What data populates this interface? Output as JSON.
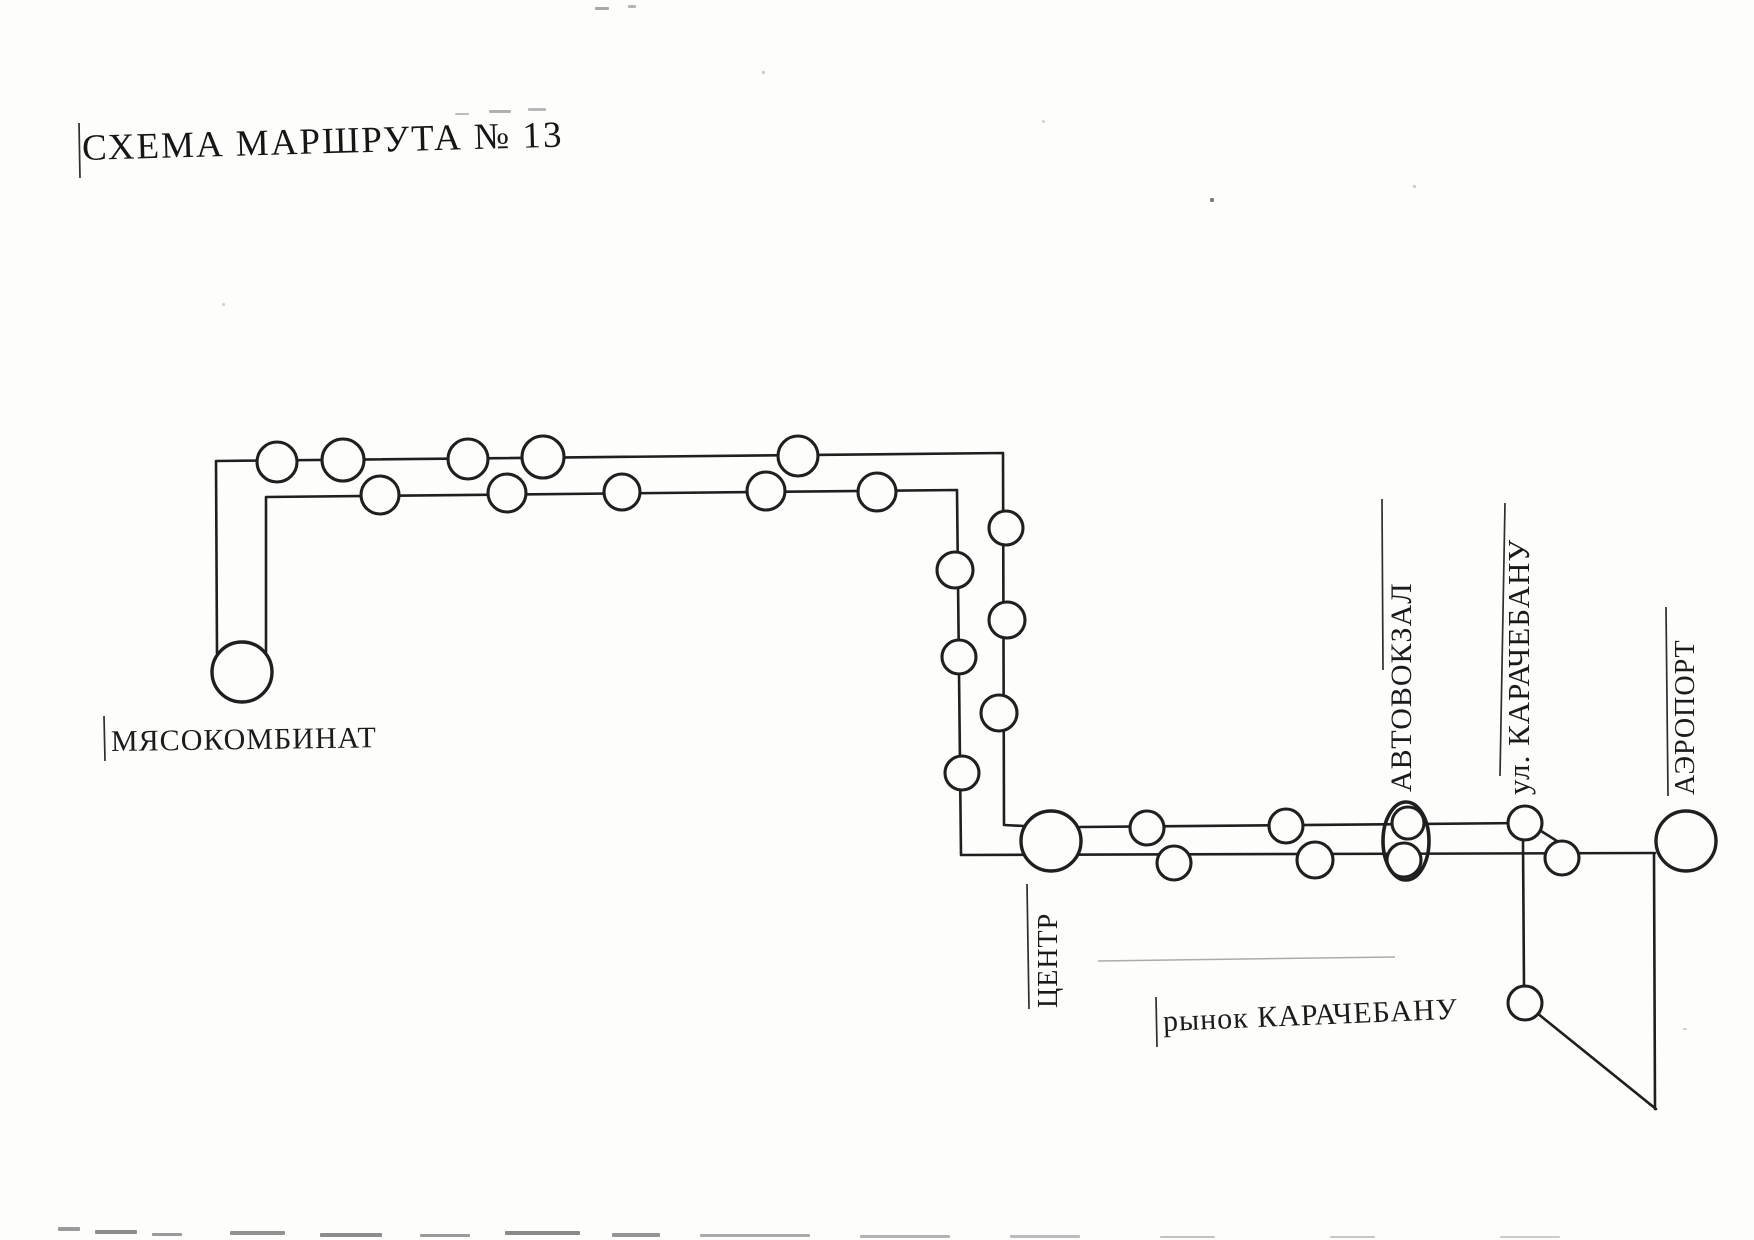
{
  "labels": {
    "title": "СХЕМА МАРШРУТА № 13",
    "myasokombinat": "МЯСОКОМБИНАТ",
    "centr": "ЦЕНТР",
    "avtovokzal": "АВТОВОКЗАЛ",
    "ul_karachebanu": "ул. КАРАЧЕБАНУ",
    "aeroport": "АЭРОПОРТ",
    "rynok_karachebanu": "рынок КАРАЧЕБАНУ"
  },
  "diagram": {
    "ink": "#1f1f1f",
    "paper": "#fdfdfc",
    "route_number": "13",
    "route_lines": [
      {
        "name": "outbound-line",
        "points": [
          [
            217,
            653
          ],
          [
            216,
            461
          ],
          [
            1003,
            453
          ],
          [
            1004,
            825
          ],
          [
            1024,
            826
          ]
        ]
      },
      {
        "name": "center-upper-line",
        "points": [
          [
            1080,
            827
          ],
          [
            1525,
            823
          ]
        ]
      },
      {
        "name": "return-line",
        "points": [
          [
            266,
            652
          ],
          [
            266,
            497
          ],
          [
            957,
            490
          ],
          [
            961,
            855
          ],
          [
            1655,
            853
          ]
        ]
      },
      {
        "name": "market-branch-line",
        "points": [
          [
            1523,
            841
          ],
          [
            1524,
            986
          ]
        ]
      },
      {
        "name": "market-diagonal-line",
        "points": [
          [
            1537,
            1013
          ],
          [
            1656,
            1109
          ]
        ]
      },
      {
        "name": "airport-branch-line",
        "points": [
          [
            1654,
            854
          ],
          [
            1655,
            1109
          ]
        ]
      },
      {
        "name": "merge-connector-line",
        "points": [
          [
            1541,
            831
          ],
          [
            1573,
            851
          ]
        ]
      }
    ],
    "faint_lines": [
      {
        "name": "faint-artifact-line",
        "color": "#ababab",
        "points": [
          [
            1098,
            961
          ],
          [
            1395,
            957
          ]
        ]
      }
    ],
    "stops": [
      {
        "x": 242,
        "y": 672,
        "r": 30,
        "label": "МЯСОКОМБИНАТ",
        "terminal": true
      },
      {
        "x": 1051,
        "y": 841,
        "r": 30,
        "label": "ЦЕНТР",
        "terminal": true
      },
      {
        "x": 1686,
        "y": 841,
        "r": 30,
        "label": "АЭРОПОРТ",
        "terminal": true
      },
      {
        "x": 277,
        "y": 462,
        "r": 20,
        "label": "",
        "terminal": false
      },
      {
        "x": 343,
        "y": 460,
        "r": 21,
        "label": "",
        "terminal": false
      },
      {
        "x": 468,
        "y": 459,
        "r": 20,
        "label": "",
        "terminal": false
      },
      {
        "x": 543,
        "y": 457,
        "r": 21,
        "label": "",
        "terminal": false
      },
      {
        "x": 798,
        "y": 456,
        "r": 20,
        "label": "",
        "terminal": false
      },
      {
        "x": 380,
        "y": 495,
        "r": 19,
        "label": "",
        "terminal": false
      },
      {
        "x": 507,
        "y": 493,
        "r": 19,
        "label": "",
        "terminal": false
      },
      {
        "x": 622,
        "y": 492,
        "r": 18,
        "label": "",
        "terminal": false
      },
      {
        "x": 766,
        "y": 491,
        "r": 19,
        "label": "",
        "terminal": false
      },
      {
        "x": 877,
        "y": 492,
        "r": 19,
        "label": "",
        "terminal": false
      },
      {
        "x": 1006,
        "y": 528,
        "r": 17,
        "label": "",
        "terminal": false
      },
      {
        "x": 1007,
        "y": 620,
        "r": 18,
        "label": "",
        "terminal": false
      },
      {
        "x": 999,
        "y": 713,
        "r": 18,
        "label": "",
        "terminal": false
      },
      {
        "x": 955,
        "y": 570,
        "r": 18,
        "label": "",
        "terminal": false
      },
      {
        "x": 959,
        "y": 657,
        "r": 17,
        "label": "",
        "terminal": false
      },
      {
        "x": 962,
        "y": 773,
        "r": 17,
        "label": "",
        "terminal": false
      },
      {
        "x": 1147,
        "y": 828,
        "r": 17,
        "label": "",
        "terminal": false
      },
      {
        "x": 1286,
        "y": 826,
        "r": 17,
        "label": "",
        "terminal": false
      },
      {
        "x": 1408,
        "y": 823,
        "r": 16,
        "label": "АВТОВОКЗАЛ",
        "terminal": false
      },
      {
        "x": 1525,
        "y": 823,
        "r": 17,
        "label": "ул. КАРАЧЕБАНУ",
        "terminal": false
      },
      {
        "x": 1174,
        "y": 863,
        "r": 17,
        "label": "",
        "terminal": false
      },
      {
        "x": 1315,
        "y": 860,
        "r": 18,
        "label": "",
        "terminal": false
      },
      {
        "x": 1404,
        "y": 860,
        "r": 17,
        "label": "АВТОВОКЗАЛ",
        "terminal": false
      },
      {
        "x": 1562,
        "y": 858,
        "r": 17,
        "label": "",
        "terminal": false
      },
      {
        "x": 1525,
        "y": 1003,
        "r": 17,
        "label": "рынок КАРАЧЕБАНУ",
        "terminal": false
      }
    ],
    "hub_oval": {
      "cx": 1406,
      "cy": 841,
      "rx": 23,
      "ry": 39,
      "label": "АВТОВОКЗАЛ"
    },
    "label_lines": [
      {
        "name": "title-tick",
        "x1": 79,
        "y1": 123,
        "x2": 80,
        "y2": 178
      },
      {
        "name": "myasokombinat-tick",
        "x1": 104,
        "y1": 716,
        "x2": 105,
        "y2": 761
      },
      {
        "name": "centr-label-line",
        "x1": 1027,
        "y1": 884,
        "x2": 1029,
        "y2": 1009
      },
      {
        "name": "avtovokzal-label-line",
        "x1": 1382,
        "y1": 499,
        "x2": 1383,
        "y2": 670
      },
      {
        "name": "karachebanu-label-line",
        "x1": 1505,
        "y1": 503,
        "x2": 1500,
        "y2": 776
      },
      {
        "name": "aeroport-label-line",
        "x1": 1666,
        "y1": 607,
        "x2": 1668,
        "y2": 796
      },
      {
        "name": "rynok-tick",
        "x1": 1156,
        "y1": 997,
        "x2": 1157,
        "y2": 1047
      }
    ],
    "artifacts": [
      {
        "x": 595,
        "y": 7,
        "w": 14,
        "h": 3,
        "c": "#a8a8a8"
      },
      {
        "x": 628,
        "y": 5,
        "w": 8,
        "h": 3,
        "c": "#b5b5b5"
      },
      {
        "x": 455,
        "y": 113,
        "w": 14,
        "h": 2,
        "c": "#bdbdbd"
      },
      {
        "x": 489,
        "y": 110,
        "w": 22,
        "h": 3,
        "c": "#b0b0b0"
      },
      {
        "x": 528,
        "y": 108,
        "w": 18,
        "h": 3,
        "c": "#b8b8b8"
      },
      {
        "x": 1210,
        "y": 198,
        "w": 4,
        "h": 4,
        "c": "#7d7d7d"
      },
      {
        "x": 762,
        "y": 71,
        "w": 3,
        "h": 3,
        "c": "#c9c9c9"
      },
      {
        "x": 1413,
        "y": 185,
        "w": 3,
        "h": 3,
        "c": "#cccccc"
      },
      {
        "x": 222,
        "y": 303,
        "w": 3,
        "h": 3,
        "c": "#d2d2d2"
      },
      {
        "x": 1042,
        "y": 120,
        "w": 3,
        "h": 3,
        "c": "#d5d5d5"
      },
      {
        "x": 1683,
        "y": 1028,
        "w": 4,
        "h": 2,
        "c": "#cfcfcf"
      },
      {
        "x": 58,
        "y": 1227,
        "w": 22,
        "h": 4,
        "c": "#9a9a9a"
      },
      {
        "x": 95,
        "y": 1230,
        "w": 42,
        "h": 4,
        "c": "#8e8e8e"
      },
      {
        "x": 152,
        "y": 1233,
        "w": 30,
        "h": 3,
        "c": "#999999"
      },
      {
        "x": 230,
        "y": 1231,
        "w": 55,
        "h": 4,
        "c": "#929292"
      },
      {
        "x": 320,
        "y": 1233,
        "w": 62,
        "h": 4,
        "c": "#8c8c8c"
      },
      {
        "x": 420,
        "y": 1234,
        "w": 50,
        "h": 3,
        "c": "#9a9a9a"
      },
      {
        "x": 505,
        "y": 1231,
        "w": 75,
        "h": 4,
        "c": "#8a8a8a"
      },
      {
        "x": 612,
        "y": 1233,
        "w": 48,
        "h": 4,
        "c": "#949494"
      },
      {
        "x": 700,
        "y": 1234,
        "w": 110,
        "h": 3,
        "c": "#ababab"
      },
      {
        "x": 860,
        "y": 1235,
        "w": 90,
        "h": 3,
        "c": "#b3b3b3"
      },
      {
        "x": 1010,
        "y": 1235,
        "w": 70,
        "h": 3,
        "c": "#bcbcbc"
      },
      {
        "x": 1160,
        "y": 1236,
        "w": 55,
        "h": 2,
        "c": "#c2c2c2"
      },
      {
        "x": 1330,
        "y": 1236,
        "w": 45,
        "h": 2,
        "c": "#c6c6c6"
      },
      {
        "x": 1500,
        "y": 1236,
        "w": 60,
        "h": 2,
        "c": "#cccccc"
      }
    ]
  }
}
